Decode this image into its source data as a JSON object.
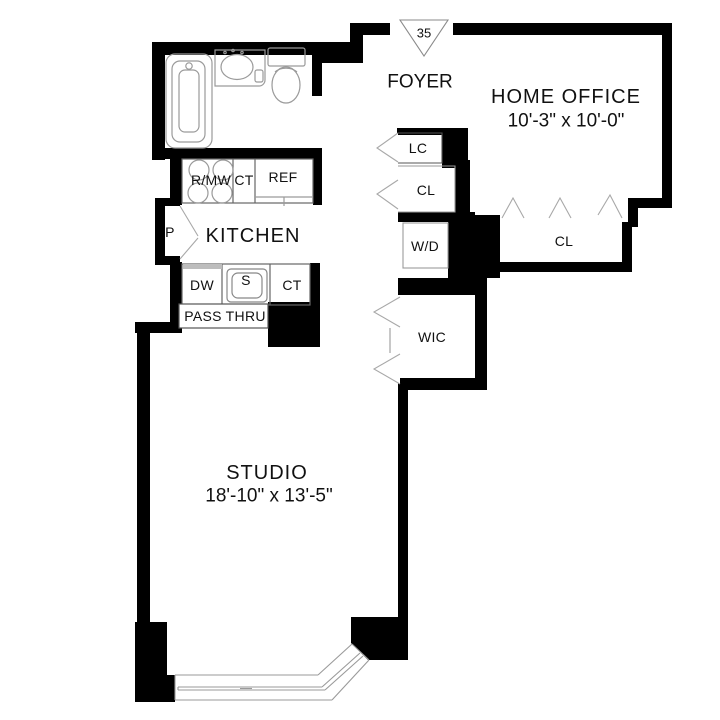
{
  "unit": {
    "number": "35"
  },
  "rooms": {
    "foyer": {
      "label": "FOYER"
    },
    "home_office": {
      "label": "HOME OFFICE",
      "dimensions": "10'-3\" x 10'-0\""
    },
    "kitchen": {
      "label": "KITCHEN"
    },
    "studio": {
      "label": "STUDIO",
      "dimensions": "18'-10\" x 13'-5\""
    }
  },
  "closets": {
    "linen_closet": {
      "label": "LC"
    },
    "foyer_closet": {
      "label": "CL"
    },
    "washer_dryer": {
      "label": "W/D"
    },
    "walk_in_closet": {
      "label": "WIC"
    },
    "office_closet": {
      "label": "CL"
    }
  },
  "kitchen_fixtures": {
    "range_microwave": {
      "label": "R/MW"
    },
    "counter_top_upper": {
      "label": "CT"
    },
    "refrigerator": {
      "label": "REF"
    },
    "dishwasher": {
      "label": "DW"
    },
    "sink": {
      "label": "S"
    },
    "counter_top_lower": {
      "label": "CT"
    },
    "pass_thru": {
      "label": "PASS THRU"
    },
    "pantry": {
      "label": "P"
    }
  },
  "colors": {
    "wall": "#000000",
    "background": "#ffffff",
    "fixture_line": "#9a9a9a",
    "thin_border": "#555555",
    "text": "#111111"
  }
}
